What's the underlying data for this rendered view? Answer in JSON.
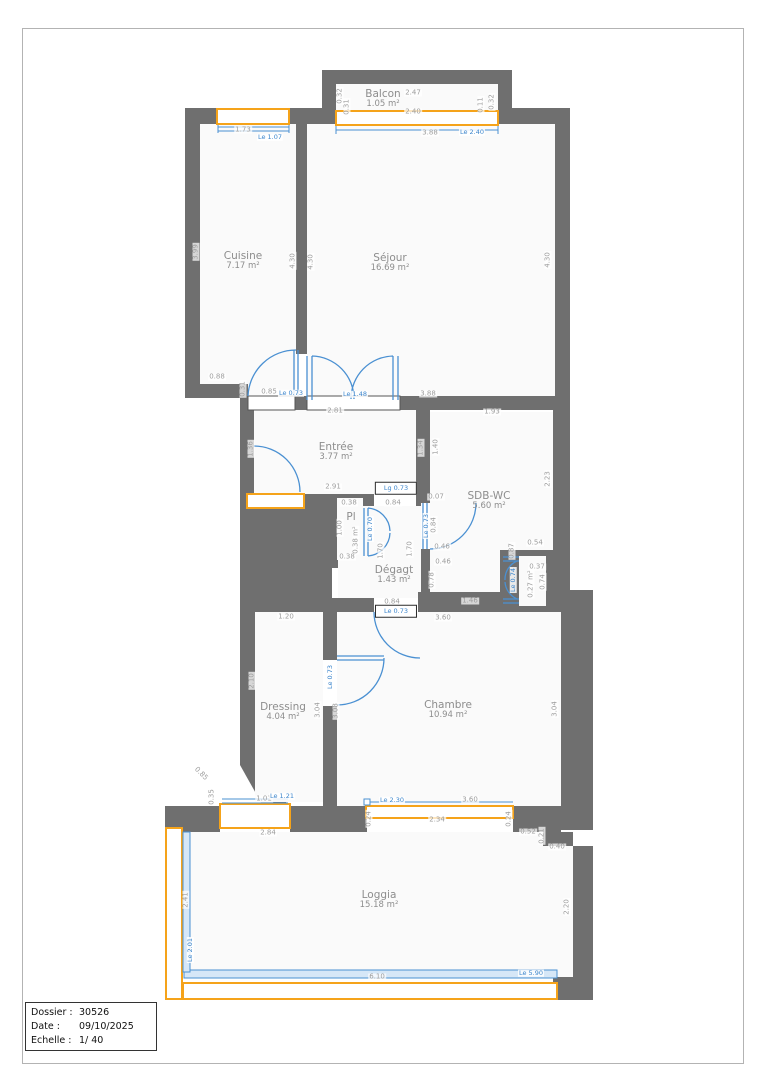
{
  "title_block": {
    "rows": [
      {
        "label": "Dossier :",
        "value": "30526"
      },
      {
        "label": "Date :",
        "value": "09/10/2025"
      },
      {
        "label": "Echelle :",
        "value": "1/ 40"
      }
    ]
  },
  "colors": {
    "wall": "#6F6F6F",
    "door_blue": "#4A90D2",
    "window_orange": "#F5A31A",
    "dim_text": "#9D9D9D",
    "room_text": "#8D8D8D"
  },
  "plan": {
    "rooms": [
      {
        "name": "Balcon",
        "area": "1.05 m²",
        "x": 383,
        "y": 99
      },
      {
        "name": "Cuisine",
        "area": "7.17 m²",
        "x": 243,
        "y": 261
      },
      {
        "name": "Séjour",
        "area": "16.69 m²",
        "x": 390,
        "y": 263
      },
      {
        "name": "Entrée",
        "area": "3.77 m²",
        "x": 336,
        "y": 452
      },
      {
        "name": "Pl",
        "area": "",
        "x": 351,
        "y": 517
      },
      {
        "name": "Dégagt",
        "area": "1.43 m²",
        "x": 394,
        "y": 575
      },
      {
        "name": "SDB-WC",
        "area": "5.60 m²",
        "x": 489,
        "y": 501
      },
      {
        "name": "Chambre",
        "area": "10.94 m²",
        "x": 448,
        "y": 710
      },
      {
        "name": "Dressing",
        "area": "4.04 m²",
        "x": 283,
        "y": 712
      },
      {
        "name": "Loggia",
        "area": "15.18 m²",
        "x": 379,
        "y": 900
      }
    ],
    "dims": [
      {
        "t": "2.47",
        "x": 413,
        "y": 93
      },
      {
        "t": "2.40",
        "x": 413,
        "y": 112
      },
      {
        "t": "0.32",
        "x": 340,
        "y": 96,
        "r": -90
      },
      {
        "t": "0.31",
        "x": 347,
        "y": 107,
        "r": -90
      },
      {
        "t": "0.11",
        "x": 481,
        "y": 105,
        "r": -90
      },
      {
        "t": "0.32",
        "x": 492,
        "y": 102,
        "r": -90
      },
      {
        "t": "3.88",
        "x": 430,
        "y": 133
      },
      {
        "t": "Le 2.40",
        "x": 472,
        "y": 132,
        "b": 1
      },
      {
        "t": "1.73",
        "x": 243,
        "y": 130
      },
      {
        "t": "Le 1.07",
        "x": 270,
        "y": 137,
        "b": 1
      },
      {
        "t": "3.99",
        "x": 196,
        "y": 252,
        "r": -90
      },
      {
        "t": "4.30",
        "x": 293,
        "y": 261,
        "r": -90
      },
      {
        "t": "4.30",
        "x": 311,
        "y": 262,
        "r": -90
      },
      {
        "t": "0.88",
        "x": 217,
        "y": 377
      },
      {
        "t": "0.31",
        "x": 243,
        "y": 389,
        "r": -90
      },
      {
        "t": "0.85",
        "x": 269,
        "y": 392
      },
      {
        "t": "Le 0.73",
        "x": 291,
        "y": 393,
        "b": 1
      },
      {
        "t": "4.30",
        "x": 548,
        "y": 260,
        "r": -90
      },
      {
        "t": "3.88",
        "x": 428,
        "y": 394
      },
      {
        "t": "Le 1.48",
        "x": 355,
        "y": 394,
        "b": 1
      },
      {
        "t": "2.81",
        "x": 335,
        "y": 411
      },
      {
        "t": "1.93",
        "x": 492,
        "y": 412
      },
      {
        "t": "1.36",
        "x": 251,
        "y": 449,
        "r": -90
      },
      {
        "t": "1.34",
        "x": 421,
        "y": 448,
        "r": -90
      },
      {
        "t": "2.91",
        "x": 333,
        "y": 487
      },
      {
        "t": "0.38",
        "x": 349,
        "y": 503
      },
      {
        "t": "1.00",
        "x": 340,
        "y": 528,
        "r": -90
      },
      {
        "t": "0.38 m²",
        "x": 356,
        "y": 540,
        "r": -90
      },
      {
        "t": "0.38",
        "x": 347,
        "y": 557
      },
      {
        "t": "0.84",
        "x": 393,
        "y": 503
      },
      {
        "t": "1.70",
        "x": 381,
        "y": 551,
        "r": -90
      },
      {
        "t": "1.70",
        "x": 410,
        "y": 549,
        "r": -90
      },
      {
        "t": "0.84",
        "x": 392,
        "y": 602
      },
      {
        "t": "Le 0.70",
        "x": 370,
        "y": 529,
        "b": 1,
        "r": -90
      },
      {
        "t": "1.40",
        "x": 436,
        "y": 447,
        "r": -90
      },
      {
        "t": "2.23",
        "x": 548,
        "y": 479,
        "r": -90
      },
      {
        "t": "0.07",
        "x": 436,
        "y": 497
      },
      {
        "t": "0.84",
        "x": 434,
        "y": 525,
        "r": -90
      },
      {
        "t": "Le 0.73",
        "x": 426,
        "y": 526,
        "b": 1,
        "r": -90
      },
      {
        "t": "0.46",
        "x": 442,
        "y": 547
      },
      {
        "t": "0.46",
        "x": 443,
        "y": 562
      },
      {
        "t": "0.78",
        "x": 432,
        "y": 580,
        "r": -90
      },
      {
        "t": "1.46",
        "x": 470,
        "y": 601
      },
      {
        "t": "0.54",
        "x": 535,
        "y": 543
      },
      {
        "t": "0.87",
        "x": 512,
        "y": 551,
        "r": -90
      },
      {
        "t": "0.37",
        "x": 537,
        "y": 567
      },
      {
        "t": "0.27 m²",
        "x": 531,
        "y": 584,
        "r": -90
      },
      {
        "t": "0.74",
        "x": 543,
        "y": 582,
        "r": -90
      },
      {
        "t": "Le 0.74",
        "x": 513,
        "y": 580,
        "b": 1,
        "r": -90
      },
      {
        "t": "3.60",
        "x": 443,
        "y": 618
      },
      {
        "t": "3.08",
        "x": 336,
        "y": 711,
        "r": -90
      },
      {
        "t": "3.04",
        "x": 555,
        "y": 709,
        "r": -90
      },
      {
        "t": "3.60",
        "x": 470,
        "y": 800
      },
      {
        "t": "Le 2.30",
        "x": 392,
        "y": 800,
        "b": 1
      },
      {
        "t": "2.34",
        "x": 437,
        "y": 820
      },
      {
        "t": "0.24",
        "x": 369,
        "y": 819,
        "r": -90
      },
      {
        "t": "0.24",
        "x": 509,
        "y": 819,
        "r": -90
      },
      {
        "t": "1.20",
        "x": 286,
        "y": 617
      },
      {
        "t": "2.10",
        "x": 252,
        "y": 681,
        "r": -90
      },
      {
        "t": "3.04",
        "x": 318,
        "y": 710,
        "r": -90
      },
      {
        "t": "Le 0.73",
        "x": 330,
        "y": 677,
        "b": 1,
        "r": -90
      },
      {
        "t": "1.01",
        "x": 264,
        "y": 799
      },
      {
        "t": "Le 1.21",
        "x": 282,
        "y": 796,
        "b": 1
      },
      {
        "t": "0.35",
        "x": 212,
        "y": 797,
        "r": -90
      },
      {
        "t": "0.85",
        "x": 201,
        "y": 774,
        "r": 45
      },
      {
        "t": "2.84",
        "x": 268,
        "y": 833
      },
      {
        "t": "2.41",
        "x": 186,
        "y": 900,
        "r": -90
      },
      {
        "t": "Le 2.01",
        "x": 190,
        "y": 950,
        "b": 1,
        "r": -90
      },
      {
        "t": "2.20",
        "x": 567,
        "y": 907,
        "r": -90
      },
      {
        "t": "0.52",
        "x": 528,
        "y": 832
      },
      {
        "t": "0.21",
        "x": 542,
        "y": 836,
        "r": -90
      },
      {
        "t": "0.40",
        "x": 557,
        "y": 847
      },
      {
        "t": "6.10",
        "x": 377,
        "y": 977
      },
      {
        "t": "Le 5.90",
        "x": 531,
        "y": 973,
        "b": 1
      }
    ],
    "door_tags": [
      {
        "t": "Lg 0.73",
        "x": 396,
        "y": 488
      },
      {
        "t": "Le 0.73",
        "x": 396,
        "y": 611
      }
    ]
  }
}
